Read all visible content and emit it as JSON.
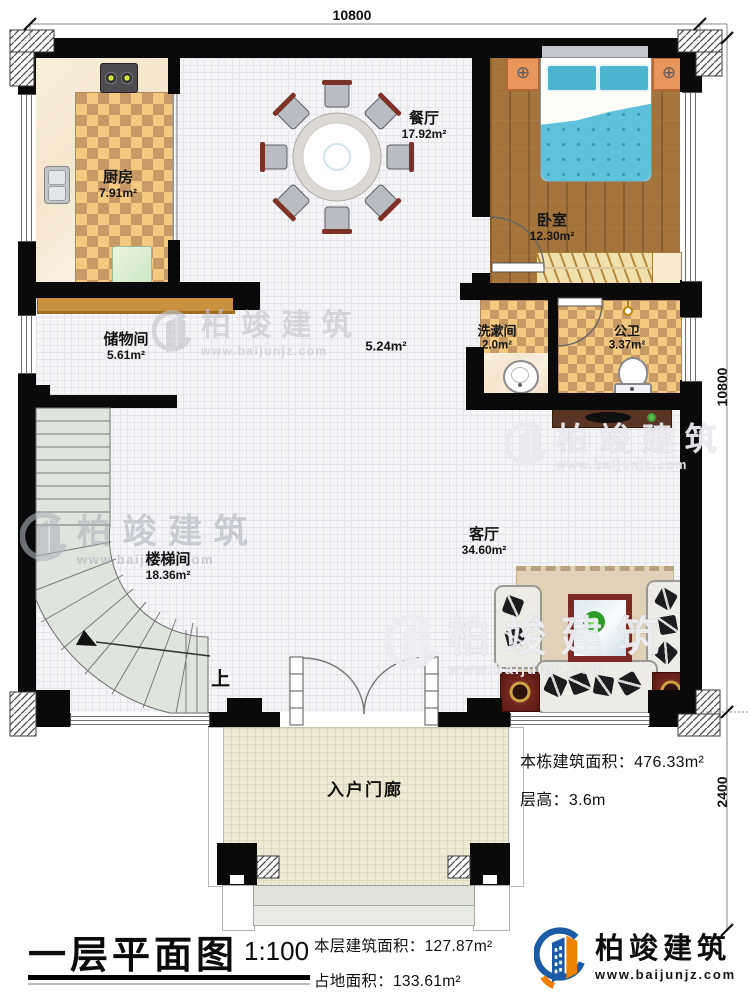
{
  "meta": {
    "title": "一层平面图",
    "scale": "1:100"
  },
  "dimensions": {
    "top": "10800",
    "right": "10800",
    "porch_depth": "2400"
  },
  "rooms": {
    "kitchen": {
      "name": "厨房",
      "area": "7.91m²"
    },
    "dining": {
      "name": "餐厅",
      "area": "17.92m²"
    },
    "bedroom": {
      "name": "卧室",
      "area": "12.30m²"
    },
    "storage": {
      "name": "储物间",
      "area": "5.61m²"
    },
    "corridor": {
      "area": "5.24m²"
    },
    "washroom": {
      "name": "洗漱间",
      "area": "2.0m²"
    },
    "toilet": {
      "name": "公卫",
      "area": "3.37m²"
    },
    "stairwell": {
      "name": "楼梯间",
      "area": "18.36m²"
    },
    "living": {
      "name": "客厅",
      "area": "34.60m²"
    },
    "porch": {
      "name": "入户门廊"
    }
  },
  "annotations": {
    "stairs_up": "上"
  },
  "stats": {
    "building_total": {
      "label": "本栋建筑面积：",
      "value": "476.33m²"
    },
    "floor_height": {
      "label": "层高：",
      "value": "3.6m"
    },
    "floor_area": {
      "label": "本层建筑面积：",
      "value": "127.87m²"
    },
    "footprint": {
      "label": "占地面积：",
      "value": "133.61m²"
    }
  },
  "branding": {
    "company": "柏竣建筑",
    "website": "www.baijunjz.com"
  },
  "watermark": {
    "company": "柏竣建筑",
    "website": "www.baijunjz.com"
  },
  "colors": {
    "wall": "#0a0a0a",
    "logo_blue": "#1d5ba6",
    "logo_orange": "#ef8200",
    "bed_blue": "#5fc1da",
    "checker_light": "#f2c97f",
    "checker_dark": "#c79a66",
    "wood": "#a5733c"
  }
}
